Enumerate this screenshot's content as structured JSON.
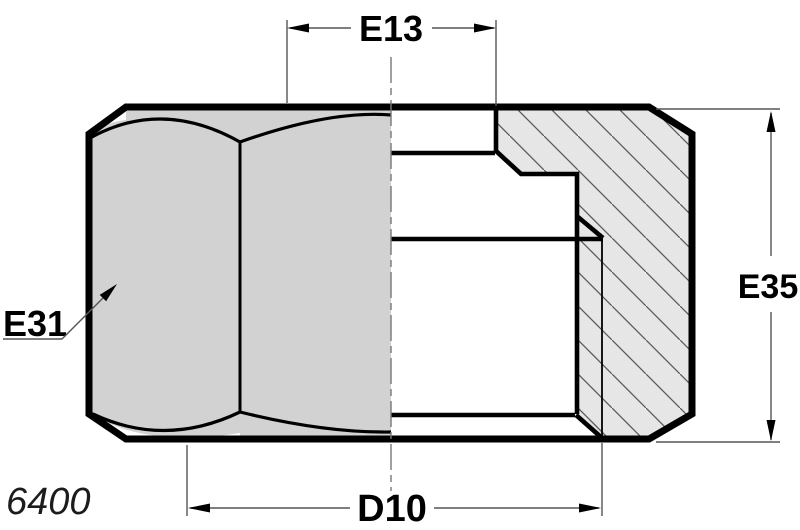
{
  "drawing": {
    "labels": {
      "top_dim": "E13",
      "right_dim": "E35",
      "left_dim": "E31",
      "bottom_dim": "D10",
      "part_code": "6400"
    },
    "colors": {
      "face_fill": "#d2d2d2",
      "section_fill": "#e6e6e6",
      "outline": "#000000",
      "thin_line": "#555555"
    }
  }
}
